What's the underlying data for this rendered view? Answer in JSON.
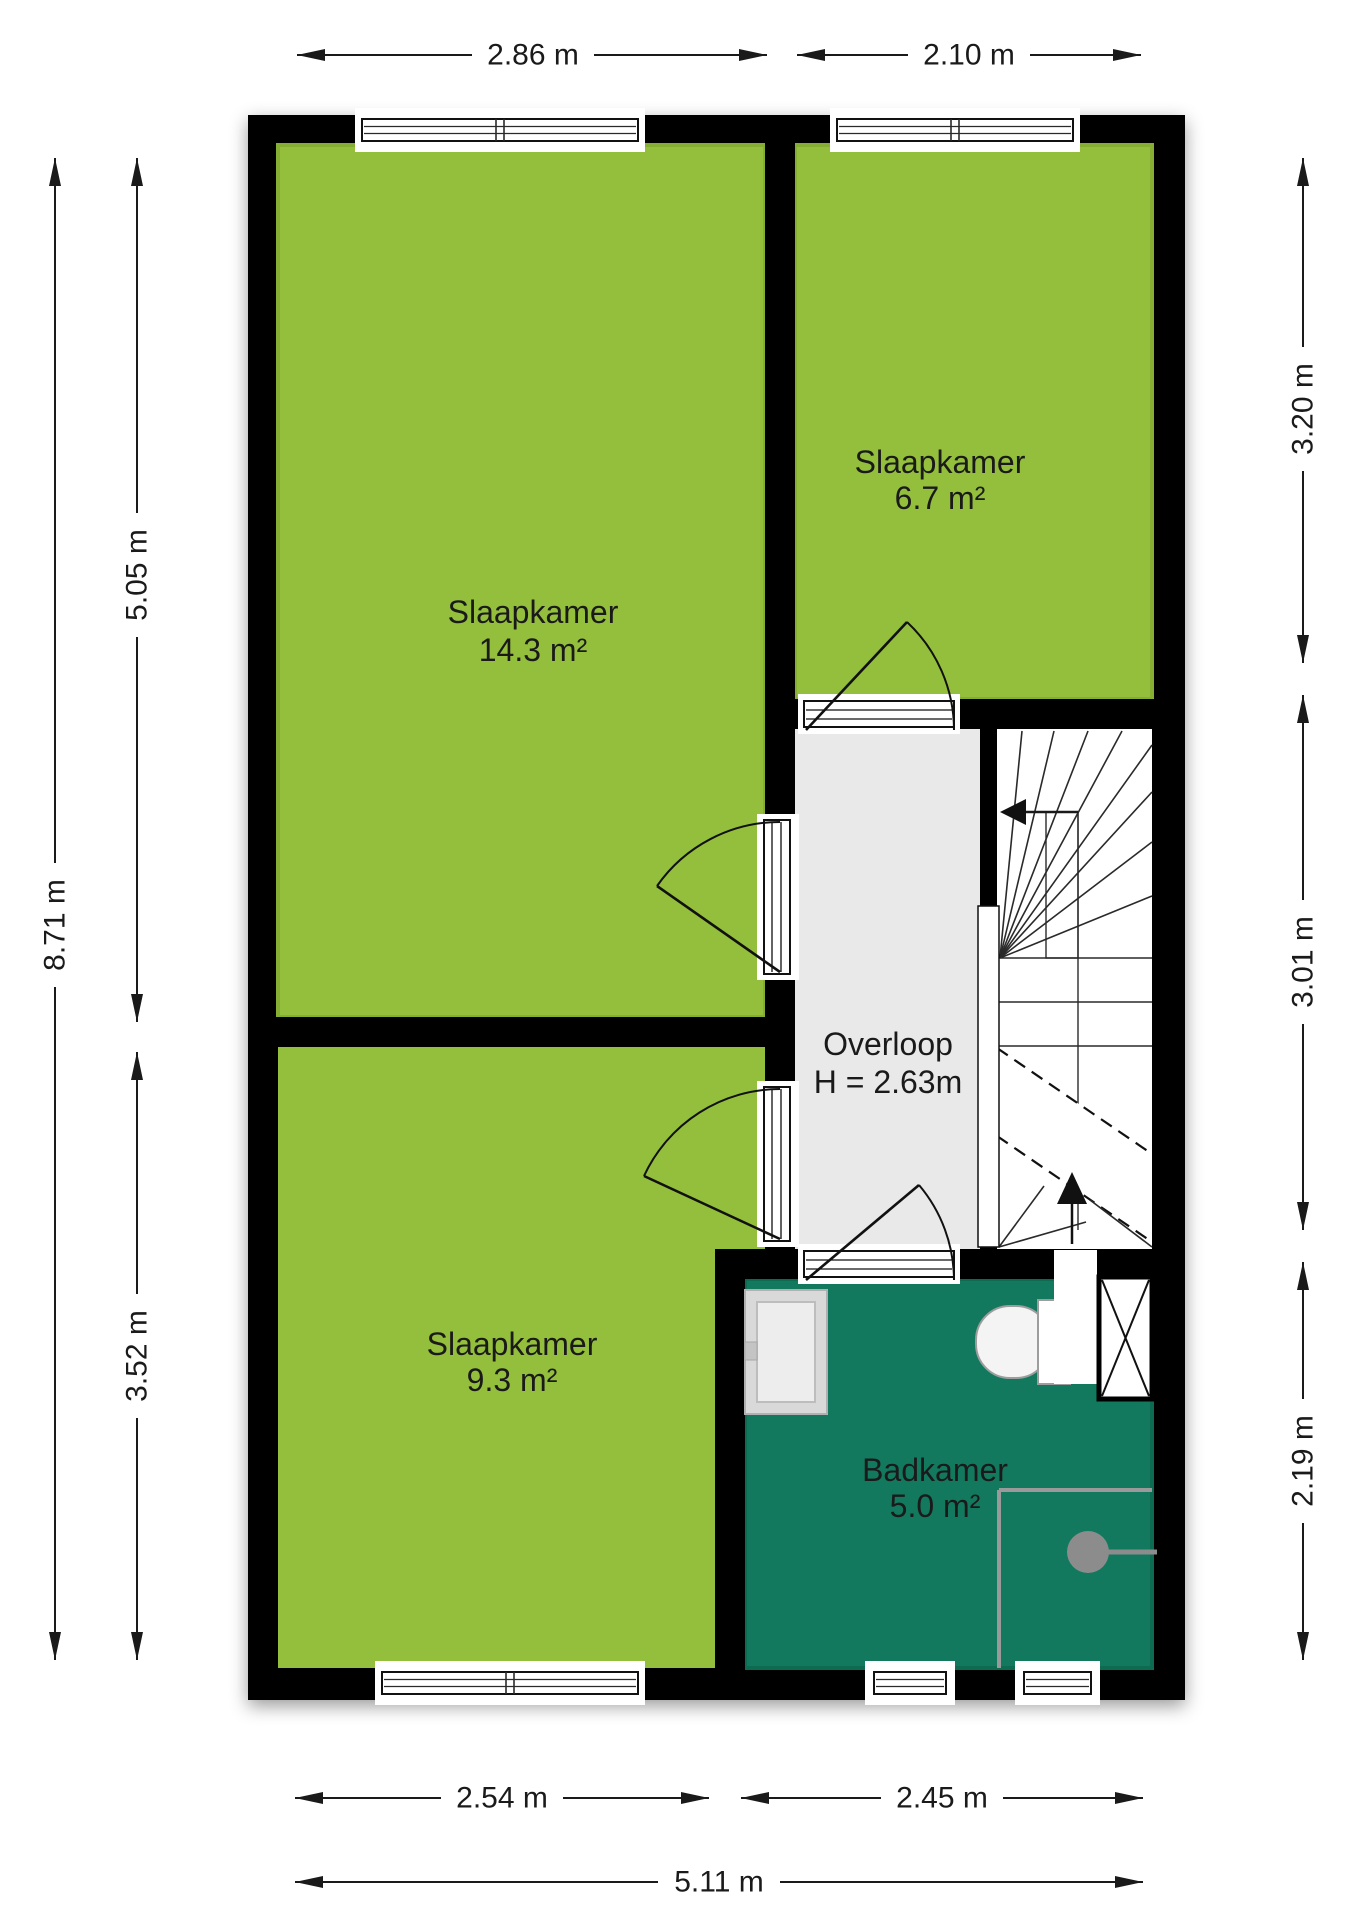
{
  "plan": {
    "title": "floor-plan-first-floor",
    "rooms": [
      {
        "id": "slaapkamer-1",
        "label": "Slaapkamer",
        "area": "14.3 m²"
      },
      {
        "id": "slaapkamer-2",
        "label": "Slaapkamer",
        "area": "6.7 m²"
      },
      {
        "id": "slaapkamer-3",
        "label": "Slaapkamer",
        "area": "9.3 m²"
      },
      {
        "id": "overloop",
        "label": "Overloop",
        "height_note": "H = 2.63m"
      },
      {
        "id": "badkamer",
        "label": "Badkamer",
        "area": "5.0 m²"
      }
    ],
    "dimensions": {
      "top": [
        "2.86 m",
        "2.10 m"
      ],
      "left_total": "8.71 m",
      "left": [
        "5.05 m",
        "3.52 m"
      ],
      "right": [
        "3.20 m",
        "3.01 m",
        "2.19 m"
      ],
      "bottom": [
        "2.54 m",
        "2.45 m"
      ],
      "bottom_total": "5.11 m"
    },
    "colors": {
      "bedroom": "#94bf3c",
      "bedroom_edge": "#85ae33",
      "bathroom": "#12795f",
      "bathroom_edge": "#0d6b52",
      "hall": "#e9e9e9",
      "stairs": "#ffffff",
      "wall": "#000000"
    }
  }
}
